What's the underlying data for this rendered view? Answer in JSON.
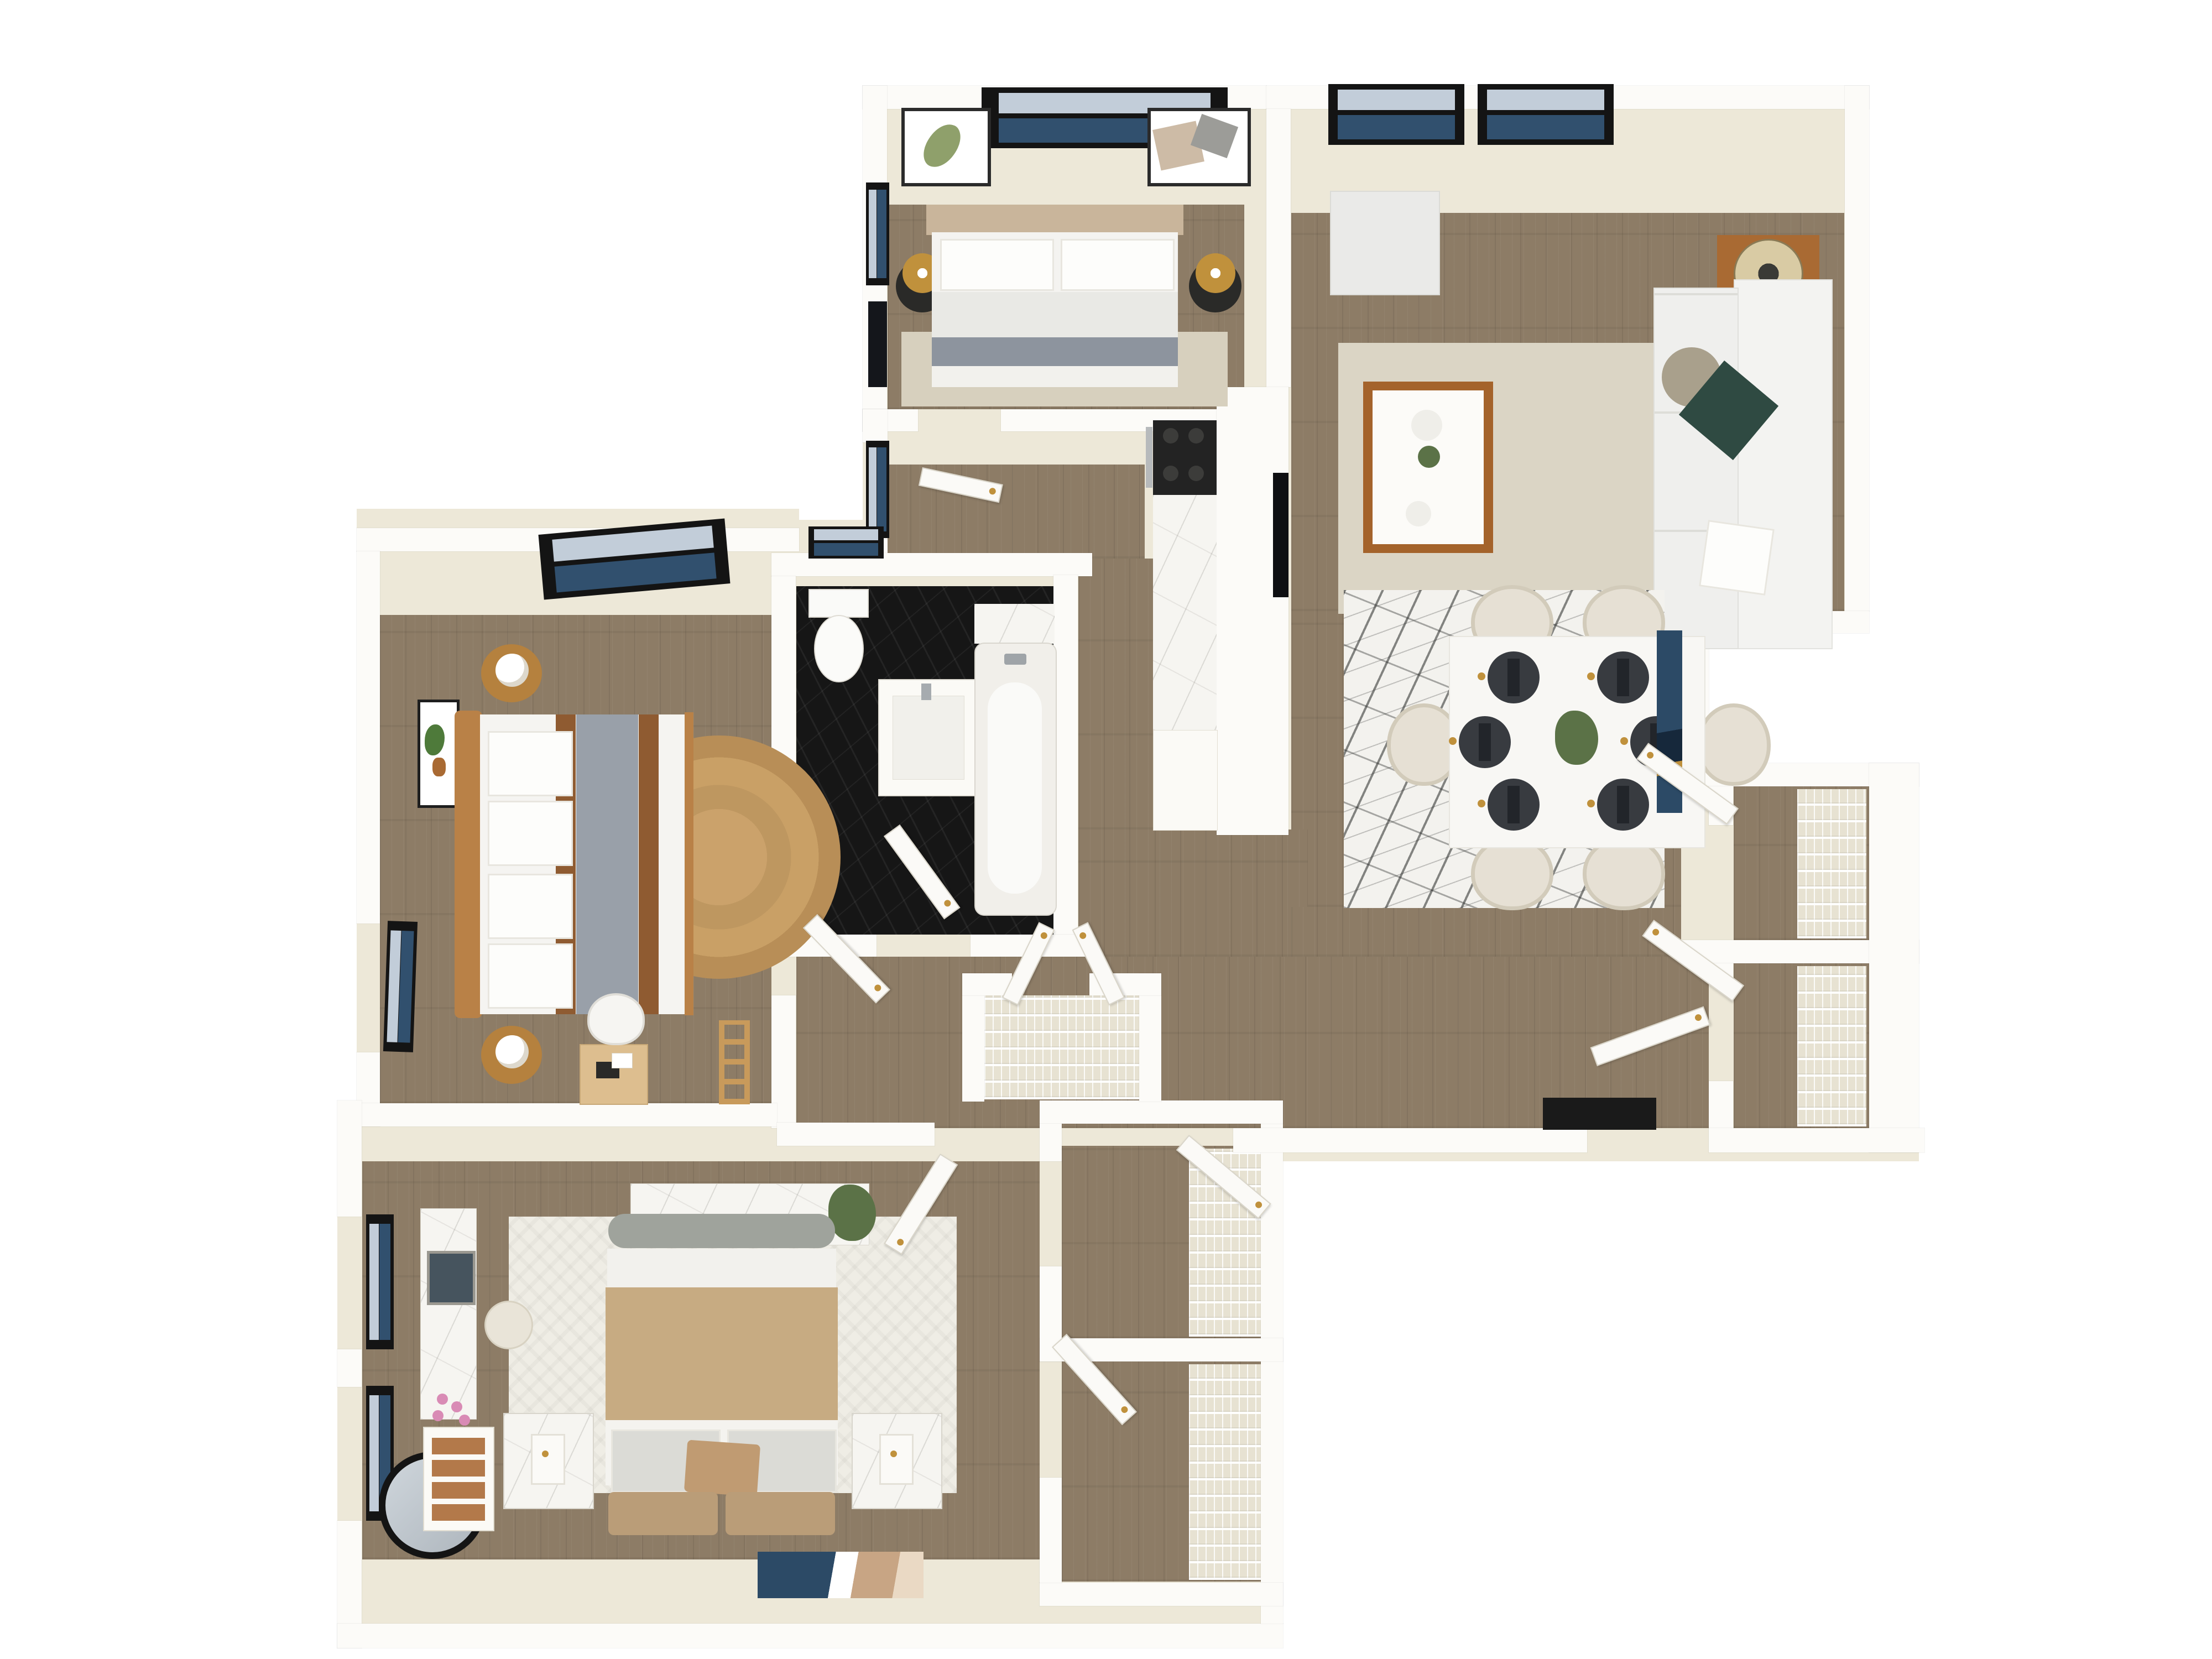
{
  "scene": {
    "kind": "3d-floor-plan-render",
    "view": "top-down dollhouse",
    "background": "#FFFFFF",
    "visible_text": "none"
  },
  "colors": {
    "wall_top": "#FCFBF8",
    "wall_face": "#EDE8D8",
    "floor_wood": "#8D7C66",
    "floor_black": "#161616",
    "marble": "#F6F5F1",
    "rug_beige": "#D7D0BE",
    "rug_living": "#DBD5C5",
    "rug_white": "#EFEDE5",
    "window_frame": "#141414",
    "glass_light": "#C2CDD9",
    "glass_dark": "#31506E",
    "gold": "#C0913C",
    "wood_accent": "#A96A33",
    "wood_light": "#DDBE8F",
    "counter_dark": "#232323",
    "cabinet_white": "#FBFAF6",
    "sofa_white": "#F3F3F1",
    "duvet_gray": "#E9E9E5",
    "blanket_gray": "#8D949E",
    "duvet_tan": "#C7AB82",
    "pillow_teal": "#2F4A42",
    "pillow_taupe": "#A9A08C",
    "door_white": "#FBFAF7",
    "mat_black": "#1A1A1A",
    "nightstand_black": "#2A2A28",
    "headboard_taupe": "#C9B59B",
    "rattan": "#B98147",
    "chair_cream": "#E6E0D4",
    "placemat_dark": "#383B40",
    "plant_green": "#5B7247",
    "blossom_pink": "#D98BB5",
    "art_blue": "#2C4A66",
    "art_tan": "#C8A584"
  },
  "rooms": [
    {
      "id": "bedroom-top",
      "name": "Bedroom 2",
      "floor": "wood",
      "furniture": [
        "queen bed with taupe headboard",
        "white pillows",
        "light gray duvet",
        "gray throw blanket",
        "beige area rug",
        "black round nightstand left",
        "black round nightstand right",
        "gold drum lamp left",
        "gold drum lamp right",
        "double window on north wall",
        "leaf art print",
        "abstract art print",
        "wall tv on west wall",
        "window on west wall"
      ]
    },
    {
      "id": "living-room",
      "name": "Living Room",
      "floor": "wood",
      "furniture": [
        "white sectional sofa",
        "teal throw pillow",
        "round taupe pillow",
        "white throw pillow",
        "white ottoman cube",
        "beige area rug",
        "white coffee table with caramel base",
        "decor plates and plant",
        "brown side table",
        "cream drum lamp",
        "wall-mounted tv",
        "two double windows on north wall"
      ]
    },
    {
      "id": "dining-area",
      "name": "Dining Area",
      "floor": "wood",
      "furniture": [
        "white rectangular dining table",
        "six cream tub chairs",
        "six charcoal place settings with gold cutlery",
        "green centerpiece plant",
        "black and white marble-pattern rug",
        "blue abstract wall art"
      ]
    },
    {
      "id": "kitchen",
      "name": "Kitchen",
      "floor": "wood",
      "furniture": [
        "black gas cooktop",
        "white marble countertop run",
        "white base cabinet",
        "cabinet wall"
      ]
    },
    {
      "id": "bathroom",
      "name": "Bathroom",
      "floor": "black slate",
      "furniture": [
        "toilet",
        "white vanity with sink",
        "bathtub with silver faucet",
        "marble tub surround",
        "window above toilet",
        "door with gold handle"
      ]
    },
    {
      "id": "bedroom-left",
      "name": "Bedroom 3",
      "floor": "wood",
      "furniture": [
        "bed with rattan headboard",
        "white duvet with gray band and rust stripes",
        "four white pillows",
        "round jute rug",
        "two round wood nightstands",
        "two white sphere lamps",
        "monstera art print",
        "light wood desk",
        "white desk chair",
        "blanket ladder",
        "wide window on north wall",
        "window on west wall"
      ]
    },
    {
      "id": "bedroom-primary",
      "name": "Primary Bedroom",
      "floor": "wood",
      "furniture": [
        "king bed with tan duvet",
        "gray bolster",
        "gray-white pillows",
        "tan accent pillow",
        "tan upholstered headboard cushions",
        "white chevron rug",
        "marble-front nightstand left",
        "marble-front nightstand right",
        "two slim lamps",
        "marble tv console",
        "flat tv",
        "potted plant",
        "marble-top vanity with square mirror",
        "round cream stool",
        "white dresser with wood drawers",
        "cherry blossom stems",
        "round black-framed mirror",
        "blue and tan wall art",
        "two windows on west wall"
      ]
    },
    {
      "id": "closet-linen",
      "name": "Linen Closet",
      "floor": "wood",
      "furniture": [
        "wire shelving",
        "double doors"
      ]
    },
    {
      "id": "closet-primary-a",
      "name": "Walk-in Closet A",
      "floor": "wood",
      "furniture": [
        "wire shelving",
        "door"
      ]
    },
    {
      "id": "closet-primary-b",
      "name": "Walk-in Closet B",
      "floor": "wood",
      "furniture": [
        "wire shelving",
        "door"
      ]
    },
    {
      "id": "closet-east-1",
      "name": "Hall Closet 1",
      "floor": "wood",
      "furniture": [
        "wire shelving",
        "door"
      ]
    },
    {
      "id": "closet-east-2",
      "name": "Hall Closet 2",
      "floor": "wood",
      "furniture": [
        "wire shelving",
        "door"
      ]
    },
    {
      "id": "entry",
      "name": "Entry",
      "floor": "wood",
      "furniture": [
        "entry door",
        "black doormat"
      ]
    },
    {
      "id": "hallway",
      "name": "Hallway",
      "floor": "wood",
      "furniture": [
        "white interior doors with gold handles"
      ]
    }
  ]
}
